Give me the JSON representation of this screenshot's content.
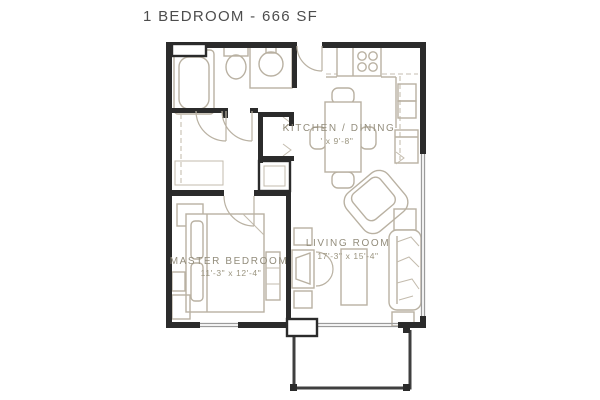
{
  "title": "1 BEDROOM - 666 SF",
  "colors": {
    "wall": "#2b2b2b",
    "furniture_line": "#b9b1a2",
    "label_text": "#938d7c",
    "title_text": "#4d4d4d",
    "window_line": "#9b9b9b",
    "patio_line": "#3f3f3f"
  },
  "rooms": {
    "kitchen_dining": {
      "label": "KITCHEN / DINING",
      "dims": "' x 9'-8\""
    },
    "living_room": {
      "label": "LIVING ROOM",
      "dims": "17'-3\" x 15'-4\""
    },
    "master_bedroom": {
      "label": "MASTER BEDROOM",
      "dims": "11'-3\" x 12'-4\""
    }
  }
}
